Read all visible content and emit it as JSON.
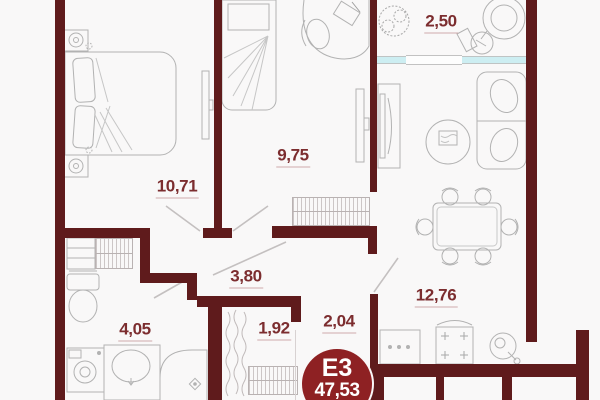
{
  "plan": {
    "badge": {
      "code": "E3",
      "total_area": "47,53"
    },
    "rooms": [
      {
        "name": "balcony",
        "area_label": "2,50"
      },
      {
        "name": "bedroom-small",
        "area_label": "9,75"
      },
      {
        "name": "bedroom-large",
        "area_label": "10,71"
      },
      {
        "name": "hallway",
        "area_label": "3,80"
      },
      {
        "name": "kitchen-living",
        "area_label": "12,76"
      },
      {
        "name": "bathroom",
        "area_label": "4,05"
      },
      {
        "name": "closet",
        "area_label": "1,92"
      },
      {
        "name": "hall-entry",
        "area_label": "2,04"
      }
    ],
    "colors": {
      "wall": "#5f1b1c",
      "room_label": "#7c2d2f",
      "badge_fill": "#8e2123",
      "window_glass": "#cdeef2",
      "furniture_outline": "#b2b2b2"
    }
  }
}
